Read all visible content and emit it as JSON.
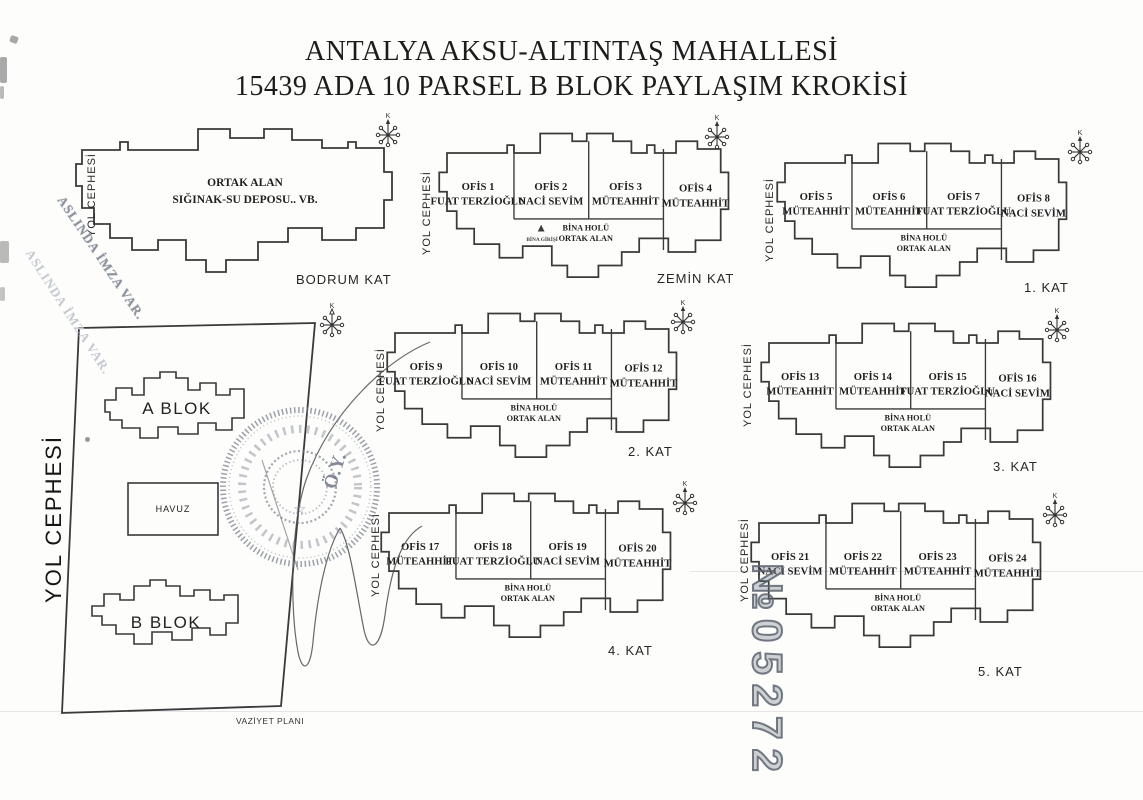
{
  "title": {
    "line1": "ANTALYA AKSU-ALTINTAŞ MAHALLESİ",
    "line2": "15439 ADA 10 PARSEL B BLOK PAYLAŞIM KROKİSİ"
  },
  "common": {
    "yol_cephesi": "YOL CEPHESİ",
    "bina_holu1": "BİNA HOLÜ",
    "bina_holu2": "ORTAK ALAN",
    "bina_girisi": "BİNA GİRİŞİ",
    "north": "K"
  },
  "floors": [
    {
      "label": "BODRUM KAT",
      "room1": "ORTAK ALAN",
      "room2": "SIĞINAK-SU DEPOSU.. VB."
    },
    {
      "label": "ZEMİN KAT",
      "offices": [
        {
          "name": "OFİS 1",
          "owner": "FUAT TERZİOĞLU"
        },
        {
          "name": "OFİS 2",
          "owner": "NACİ SEVİM"
        },
        {
          "name": "OFİS 3",
          "owner": "MÜTEAHHİT"
        },
        {
          "name": "OFİS 4",
          "owner": "MÜTEAHHİT"
        }
      ]
    },
    {
      "label": "1. KAT",
      "offices": [
        {
          "name": "OFİS 5",
          "owner": "MÜTEAHHİT"
        },
        {
          "name": "OFİS 6",
          "owner": "MÜTEAHHİT"
        },
        {
          "name": "OFİS 7",
          "owner": "FUAT TERZİOĞLU"
        },
        {
          "name": "OFİS 8",
          "owner": "NACİ SEVİM"
        }
      ]
    },
    {
      "label": "2. KAT",
      "offices": [
        {
          "name": "OFİS 9",
          "owner": "FUAT TERZİOĞLU"
        },
        {
          "name": "OFİS 10",
          "owner": "NACİ SEVİM"
        },
        {
          "name": "OFİS 11",
          "owner": "MÜTEAHHİT"
        },
        {
          "name": "OFİS 12",
          "owner": "MÜTEAHHİT"
        }
      ]
    },
    {
      "label": "3. KAT",
      "offices": [
        {
          "name": "OFİS 13",
          "owner": "MÜTEAHHİT"
        },
        {
          "name": "OFİS 14",
          "owner": "MÜTEAHHİT"
        },
        {
          "name": "OFİS 15",
          "owner": "FUAT TERZİOĞLU"
        },
        {
          "name": "OFİS 16",
          "owner": "NACİ SEVİM"
        }
      ]
    },
    {
      "label": "4. KAT",
      "offices": [
        {
          "name": "OFİS 17",
          "owner": "MÜTEAHHİT"
        },
        {
          "name": "OFİS 18",
          "owner": "FUAT TERZİOĞLU"
        },
        {
          "name": "OFİS 19",
          "owner": "NACİ SEVİM"
        },
        {
          "name": "OFİS 20",
          "owner": "MÜTEAHHİT"
        }
      ]
    },
    {
      "label": "5. KAT",
      "offices": [
        {
          "name": "OFİS 21",
          "owner": "NACİ SEVİM"
        },
        {
          "name": "OFİS 22",
          "owner": "MÜTEAHHİT"
        },
        {
          "name": "OFİS 23",
          "owner": "MÜTEAHHİT"
        },
        {
          "name": "OFİS 24",
          "owner": "MÜTEAHHİT"
        }
      ]
    }
  ],
  "site_plan": {
    "yol_cephesi": "YOL CEPHESİ",
    "a_blok": "A BLOK",
    "havuz": "HAVUZ",
    "b_blok": "B BLOK",
    "caption": "VAZİYET PLANI"
  },
  "stamps": {
    "aslinda_imza": "ASLINDA İMZA VAR.",
    "serial": "№05272",
    "seal_star": "☆",
    "seal_initials": "Ö.Y."
  },
  "colors": {
    "ink": "#3a3a3a",
    "stamp_ink": "#7b828e",
    "paper": "#fdfdfc"
  }
}
